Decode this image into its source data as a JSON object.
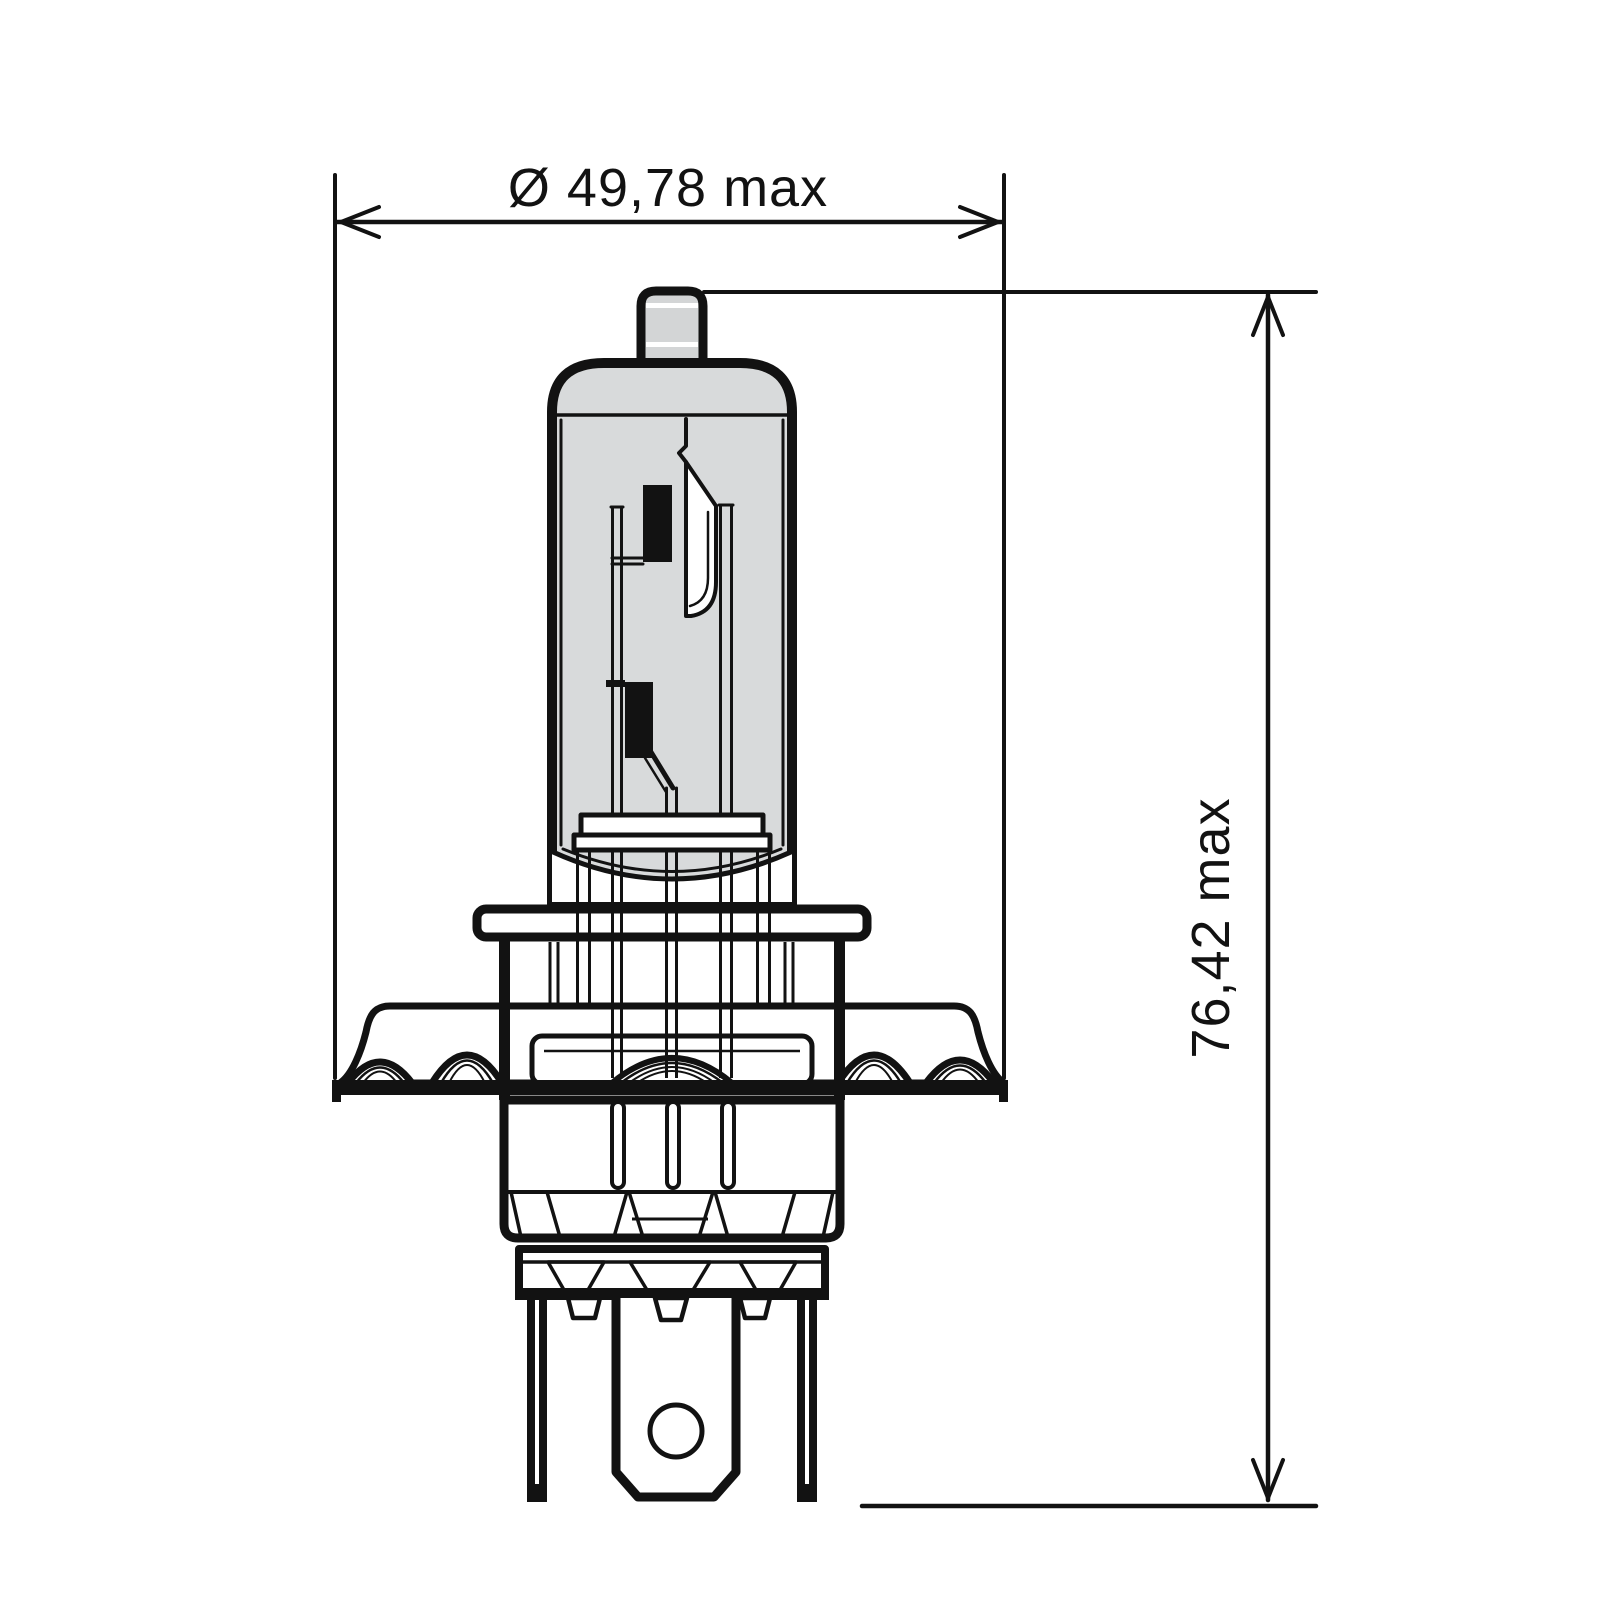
{
  "drawing": {
    "type": "technical-dimension-drawing",
    "subject": "halogen-headlight-bulb-side-view",
    "dimensions": {
      "diameter": {
        "label": "Ø 49,78 max",
        "symbol": "Ø",
        "value": "49,78",
        "qualifier": "max",
        "orientation": "horizontal"
      },
      "height": {
        "label": "76,42 max",
        "value": "76,42",
        "qualifier": "max",
        "orientation": "vertical"
      }
    },
    "colors": {
      "line": "#121212",
      "glass_fill": "#d8dadb",
      "tip_fill": "#d3d5d6",
      "background": "#ffffff"
    }
  }
}
